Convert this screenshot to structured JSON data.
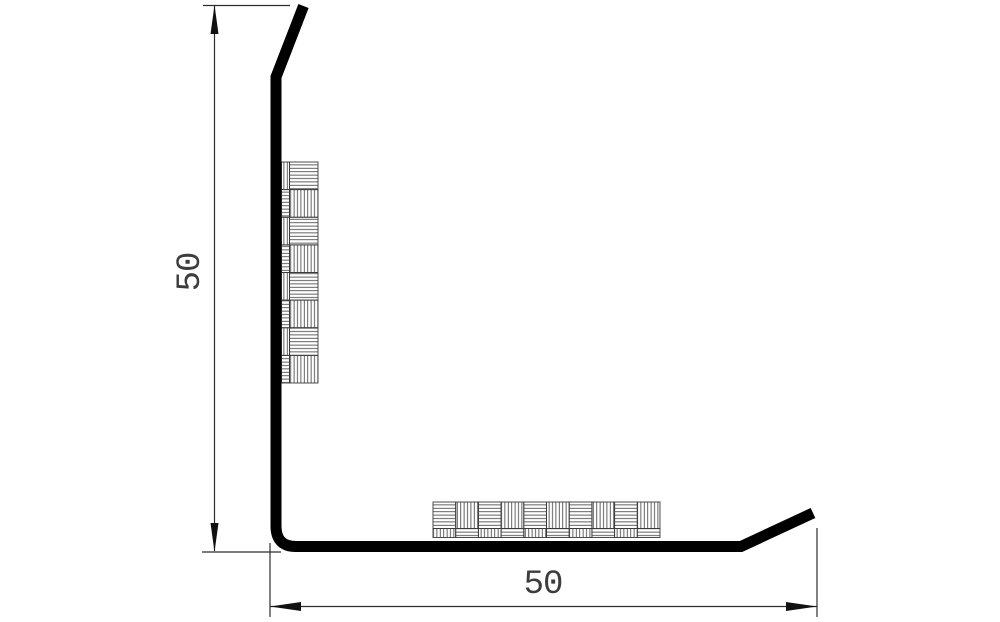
{
  "drawing": {
    "type": "technical-cross-section",
    "subject": "L-shaped angle profile (50 x 50) with hatched adhesive tape strips on inner faces",
    "dimension_vertical": {
      "value": "50"
    },
    "dimension_horizontal": {
      "value": "50"
    },
    "colors": {
      "profile": "#000000",
      "dimension_lines": "#2e2e2e",
      "hatch": "#3a3a3a",
      "text": "#3d3d3d",
      "background": "#ffffff"
    }
  }
}
